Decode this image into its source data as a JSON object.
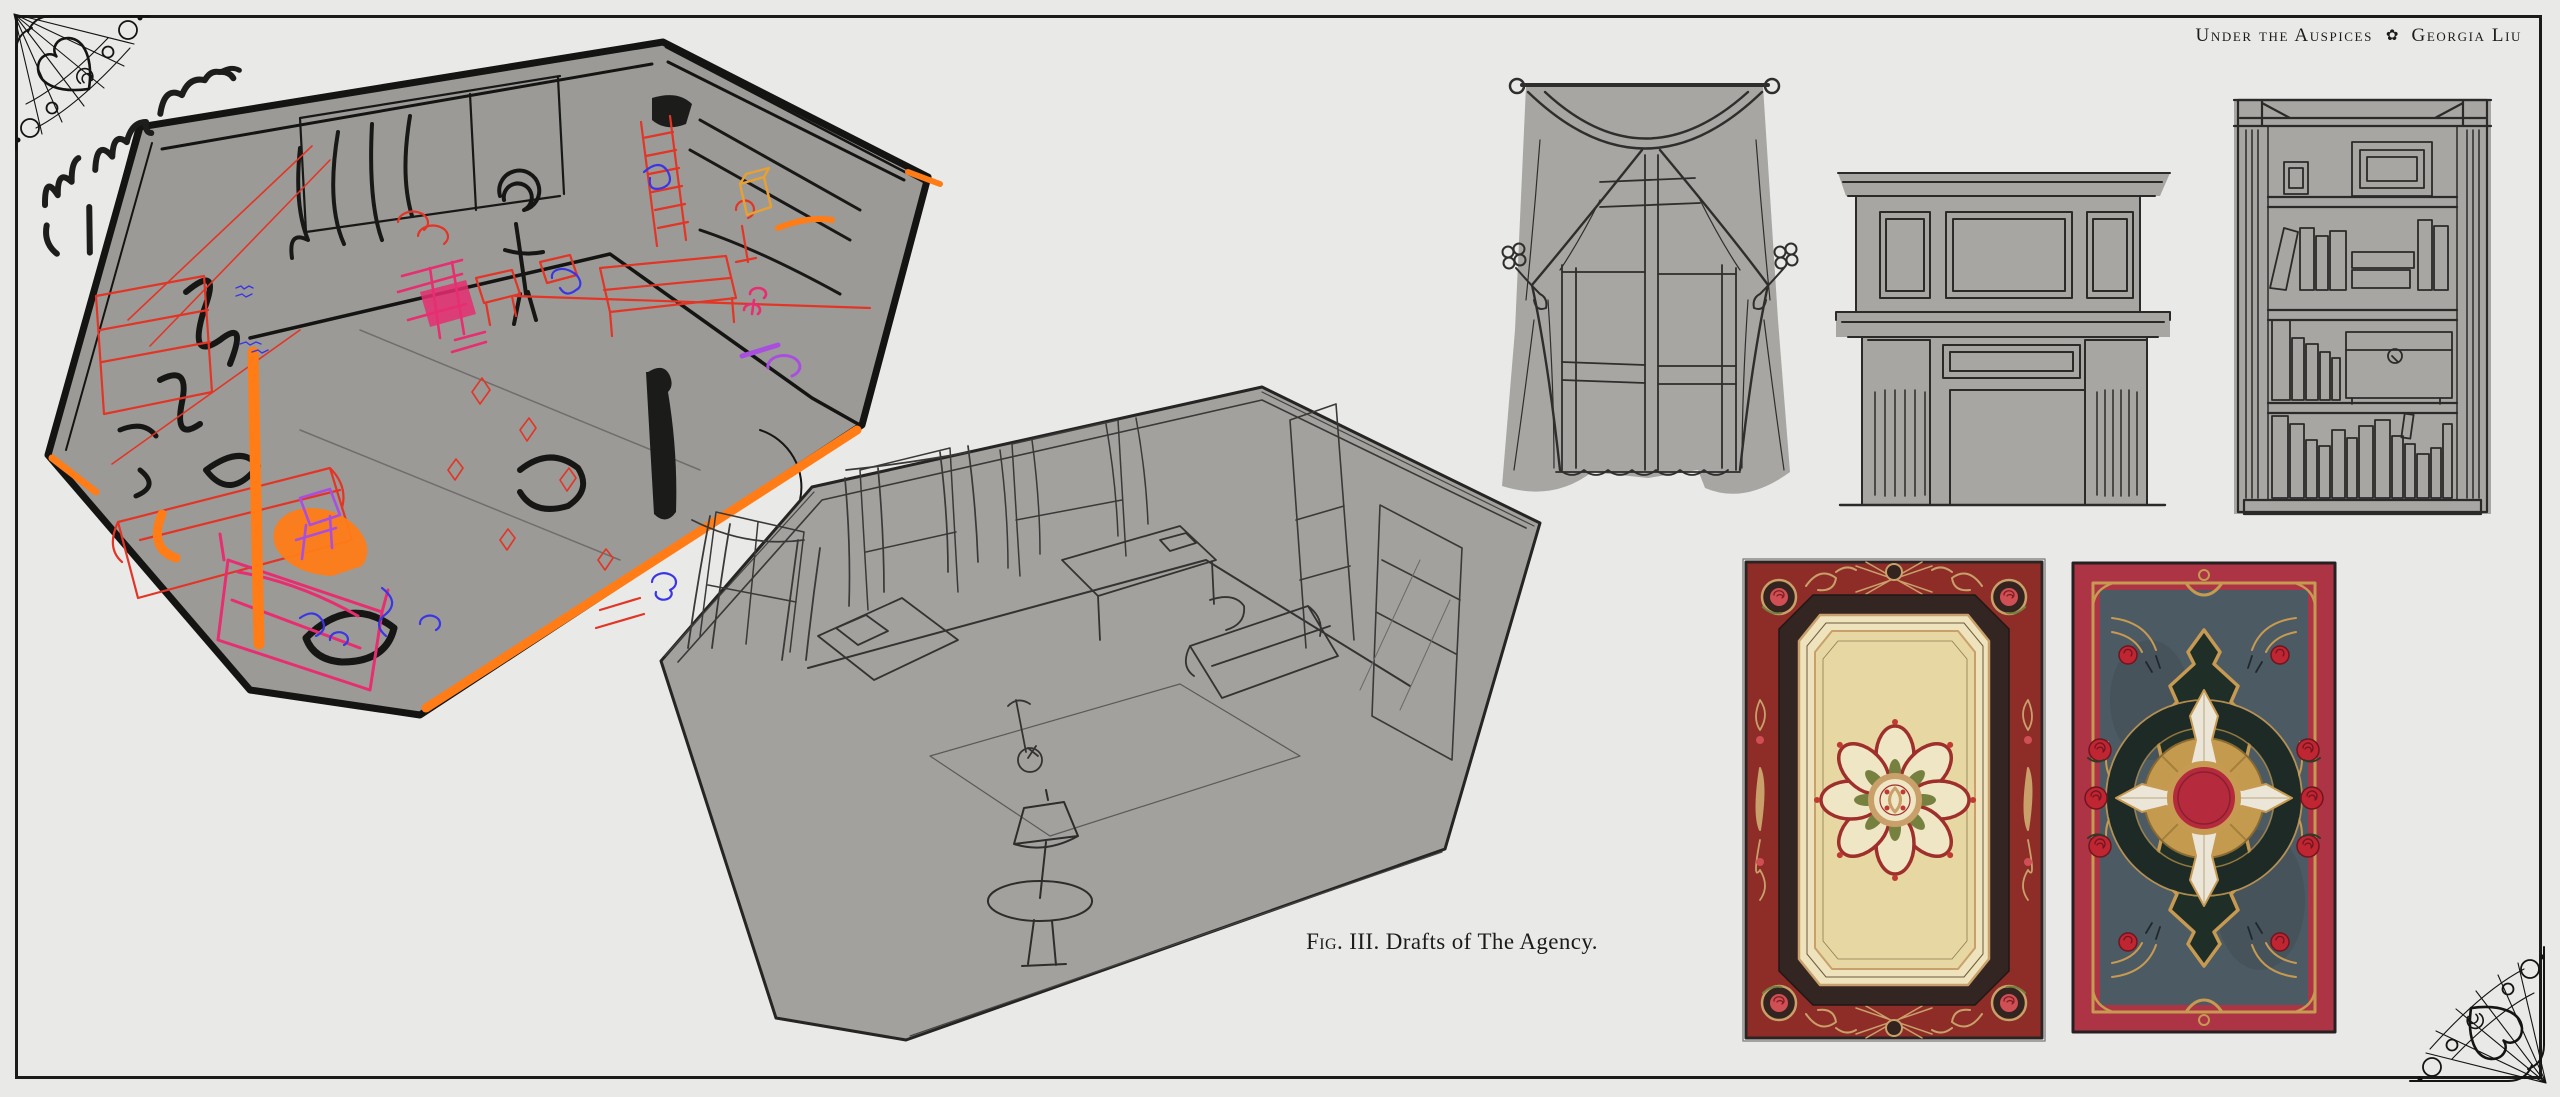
{
  "header": {
    "title": "Under the Auspices",
    "separator_char": "✿",
    "author": "Georgia Liu"
  },
  "caption": {
    "fig": "Fig.",
    "rest": "III. Drafts of The Agency."
  },
  "annotations": {
    "handwritten_note": "draw curtains when open"
  },
  "palette": {
    "page_background": "#e9e9e8",
    "frame_ink": "#1b1b1a",
    "sketch_fill_gray": "#9c9a97",
    "clean_sketch_fill": "#a3a19e",
    "prop_sketch_fill": "#a8a6a3",
    "scribble_red": "#e23526",
    "scribble_magenta": "#e62e70",
    "scribble_orange": "#ff7c17",
    "scribble_blue": "#3a36e6",
    "scribble_purple": "#a94fe0",
    "rug_left_border_red": "#8e2d28",
    "rug_left_frame_brown": "#332522",
    "rug_left_cream": "#eee3bc",
    "rug_left_field": "#e7d7a2",
    "rug_left_gold": "#c9a06a",
    "rug_left_green": "#76803f",
    "rug_left_rose": "#cf4f55",
    "rug_right_border_red": "#ad3444",
    "rug_right_gold": "#c79a52",
    "rug_right_slate": "#4b5a63",
    "rug_right_cartouche_green": "#202e28",
    "rug_right_cross_cream": "#ece6d8",
    "rug_right_center_red": "#b52a3c"
  }
}
